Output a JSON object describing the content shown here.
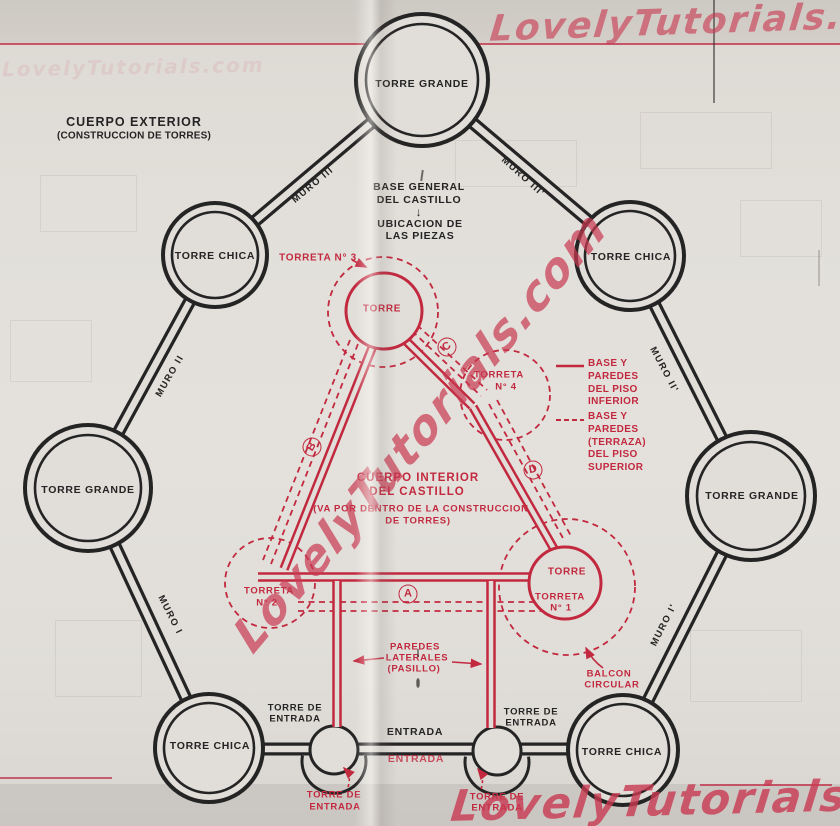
{
  "watermark": {
    "text": "LovelyTutorials.com"
  },
  "colors": {
    "diagram_red": "#c2293f",
    "diagram_black": "#242424",
    "watermark_pink": "#c93a52",
    "paper": "#e1ded9"
  },
  "exterior": {
    "title": "CUERPO EXTERIOR",
    "subtitle": "(CONSTRUCCION DE TORRES)",
    "center_note": {
      "l1": "BASE GENERAL",
      "l2": "DEL CASTILLO",
      "arrow": "↓",
      "l3": "UBICACION DE",
      "l4": "LAS PIEZAS"
    },
    "torre_grande": "TORRE GRANDE",
    "torre_chica": "TORRE CHICA",
    "muro_1": "MURO I",
    "muro_2": "MURO II",
    "muro_3": "MURO III",
    "muro_1p": "MURO I'",
    "muro_2p": "MURO II'",
    "muro_3p": "MURO III'",
    "entrada": "ENTRADA",
    "torre_entrada_l1": "TORRE DE",
    "torre_entrada_l2": "ENTRADA"
  },
  "interior": {
    "title_l1": "CUERPO INTERIOR",
    "title_l2": "DEL CASTILLO",
    "note_l1": "(VA POR DENTRO DE LA CONSTRUCCION",
    "note_l2": "DE TORRES)",
    "torre": "TORRE",
    "torreta_word": "TORRETA",
    "torreta_n1": "N° 1",
    "torreta_n2": "N° 2",
    "torreta_n3_label": "TORRETA N° 3",
    "torreta_n4": "N° 4",
    "letter_a": "A",
    "letter_b": "B",
    "letter_c": "C",
    "letter_d": "D",
    "paredes_l1": "PAREDES",
    "paredes_l2": "LATERALES",
    "paredes_l3": "(PASILLO)",
    "balcon_l1": "BALCON",
    "balcon_l2": "CIRCULAR",
    "entrada": "ENTRADA",
    "torre_entrada_l1": "TORRE DE",
    "torre_entrada_l2": "ENTRADA"
  },
  "legend": {
    "inferior": [
      "BASE Y",
      "PAREDES",
      "DEL PISO",
      "INFERIOR"
    ],
    "superior": [
      "BASE Y",
      "PAREDES",
      "(TERRAZA)",
      "DEL PISO",
      "SUPERIOR"
    ]
  }
}
